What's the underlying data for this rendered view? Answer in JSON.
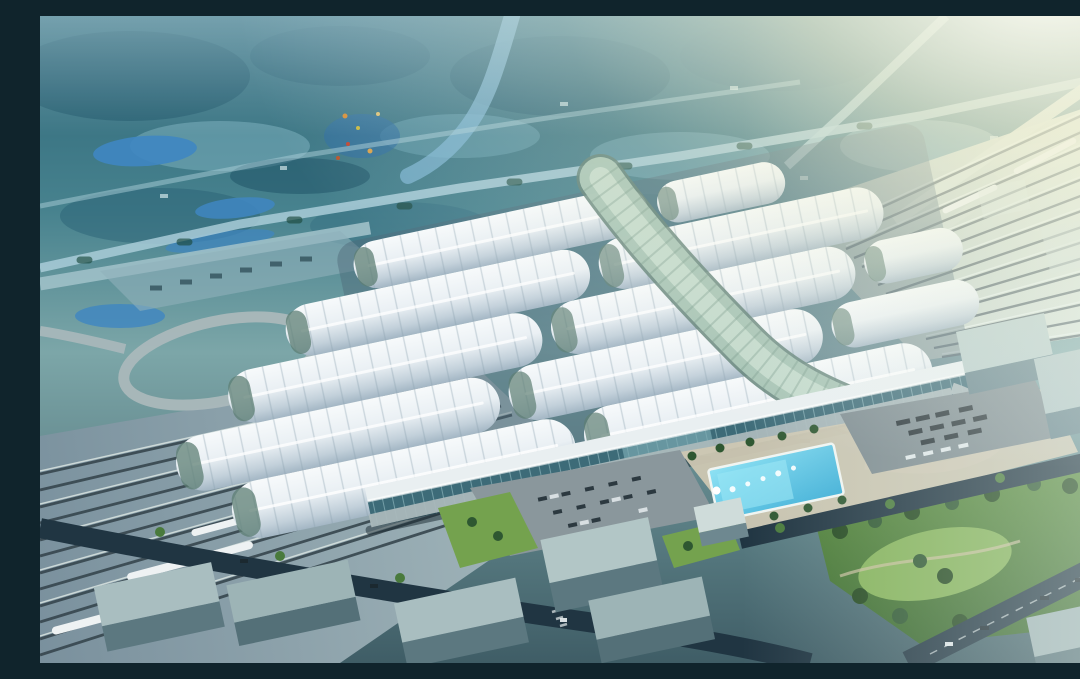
{
  "scene": {
    "title": "Aerial rendering of a high-speed railway station",
    "caption": "Daytime aerial CGI masterplan rendering of a huge high-speed railway station. The station roof is a staggered grid of white barrel-vault shells crossed diagonally by a curving green-glass spine. Elevated rail viaducts fan out to the upper right and lower left with white trains. In front of the teal glass facade are curved ramp roads, a beige forecourt plaza with a bright cyan fountain pool, parking lots with buses and cars, a green park, and grey glass city blocks. The surrounding landscape is hazy teal farmland with ponds, tree-lined roads and a river, washed out by strong sun glare from the upper right corner.",
    "style": "architectural CGI rendering",
    "time_of_day": "day, hazy sunlight from upper right"
  },
  "counts": {
    "roof_vault_rows": 5,
    "roof_vault_segments": 12,
    "tracks_right_fan": 15,
    "tracks_left_fan": 12,
    "trains_visible": 6,
    "fountain_jets": 5,
    "city_blocks": 10
  },
  "palette": {
    "landscapeDeep": "#1d5468",
    "landscapeMid": "#32708a",
    "landscapeLight": "#7fb3c2",
    "pondBlue": "#3f86c2",
    "riverBlue": "#7fb6d4",
    "roadLight": "#a9cdd8",
    "flareWhite": "#fffef5",
    "roofWhite": "#eef4f7",
    "roofShade": "#a3b6c4",
    "spineGlass": "#a9c6b6",
    "spineGlassDark": "#5e7f74",
    "trackDeckRight": "#c7d2c4",
    "trackDeckLeft": "#8fa3ad",
    "trackLineDark": "#45565e",
    "railShine": "#e8f1ee",
    "asphaltDark": "#203542",
    "rampGrey": "#aab8bb",
    "pavingBeige": "#cdc7b2",
    "poolCyan": "#58c9ea",
    "lawnGreen": "#74a24e",
    "treeDark": "#2e5731",
    "treeMid": "#497a3c",
    "buildingGlassTop": "#a9bec0",
    "buildingFace": "#5c7880",
    "facadeFascia": "#e9eff1",
    "facadeGlass": "#3d6b78",
    "trainWhite": "#eef2f3",
    "vehicleDark": "#2c3940"
  },
  "elements": [
    {
      "name": "station-roof",
      "description": "staggered white barrel-vault roof shells with rib lines and green glass end gables"
    },
    {
      "name": "glass-spine",
      "description": "curved central glass vault crossing the roofs diagonally"
    },
    {
      "name": "station-facade",
      "description": "white fascia over teal glass curtain wall with elevated drop-off road"
    },
    {
      "name": "rail-fan-right",
      "description": "elevated viaduct tracks fanning to the upper right with trains"
    },
    {
      "name": "rail-fan-left",
      "description": "tracks fanning to the lower left with white trains"
    },
    {
      "name": "loop-ramp",
      "description": "oval elevated road loop west of the station"
    },
    {
      "name": "fountain-pool",
      "description": "bright cyan rectangular pool with white fountain jets"
    },
    {
      "name": "bus-parking",
      "description": "parking lot with rows of dark buses"
    },
    {
      "name": "car-parking",
      "description": "forecourt parking lot with cars"
    },
    {
      "name": "park",
      "description": "green park with lawns and dense tree clusters"
    },
    {
      "name": "city-blocks",
      "description": "grey-green glass slab buildings along dark boulevards"
    },
    {
      "name": "landscape",
      "description": "hazy teal farmland with ponds, river and tree-lined roads"
    },
    {
      "name": "sun-flare",
      "description": "strong white-yellow glare from the top right corner"
    }
  ]
}
